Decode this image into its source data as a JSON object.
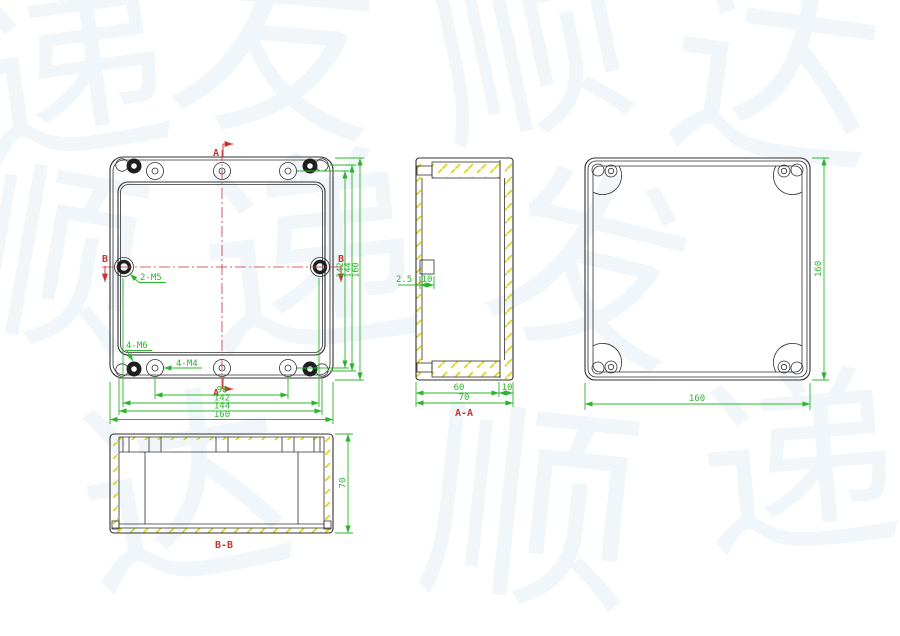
{
  "colors": {
    "outline": "#303030",
    "dimension_green": "#2cb52c",
    "section_red": "#cc3333",
    "hatch_yellow": "#d9d400",
    "watermark_blue": "#6e9cd2"
  },
  "front_view": {
    "marker_a": "A",
    "marker_b": "B",
    "label_side_screws": "2-M5",
    "label_corner_screws": "4-M6",
    "label_lid_screws": "4-M4",
    "dims_bottom": [
      "96",
      "142",
      "144",
      "160"
    ],
    "dims_right": [
      "142",
      "144",
      "160"
    ]
  },
  "section_aa": {
    "label": "A-A",
    "dim_boss_offset": "2.5",
    "dim_boss_width": "10",
    "dim_body_depth": "60",
    "dim_lid_depth": "10",
    "dim_overall_depth": "70"
  },
  "back_view": {
    "dim_width": "160",
    "dim_height": "160"
  },
  "section_bb": {
    "label": "B-B",
    "dim_depth": "70"
  },
  "watermark": {
    "glyphs": [
      "递",
      "发",
      "顺",
      "达",
      "顺",
      "递",
      "发",
      "达",
      "顺",
      "递"
    ]
  }
}
